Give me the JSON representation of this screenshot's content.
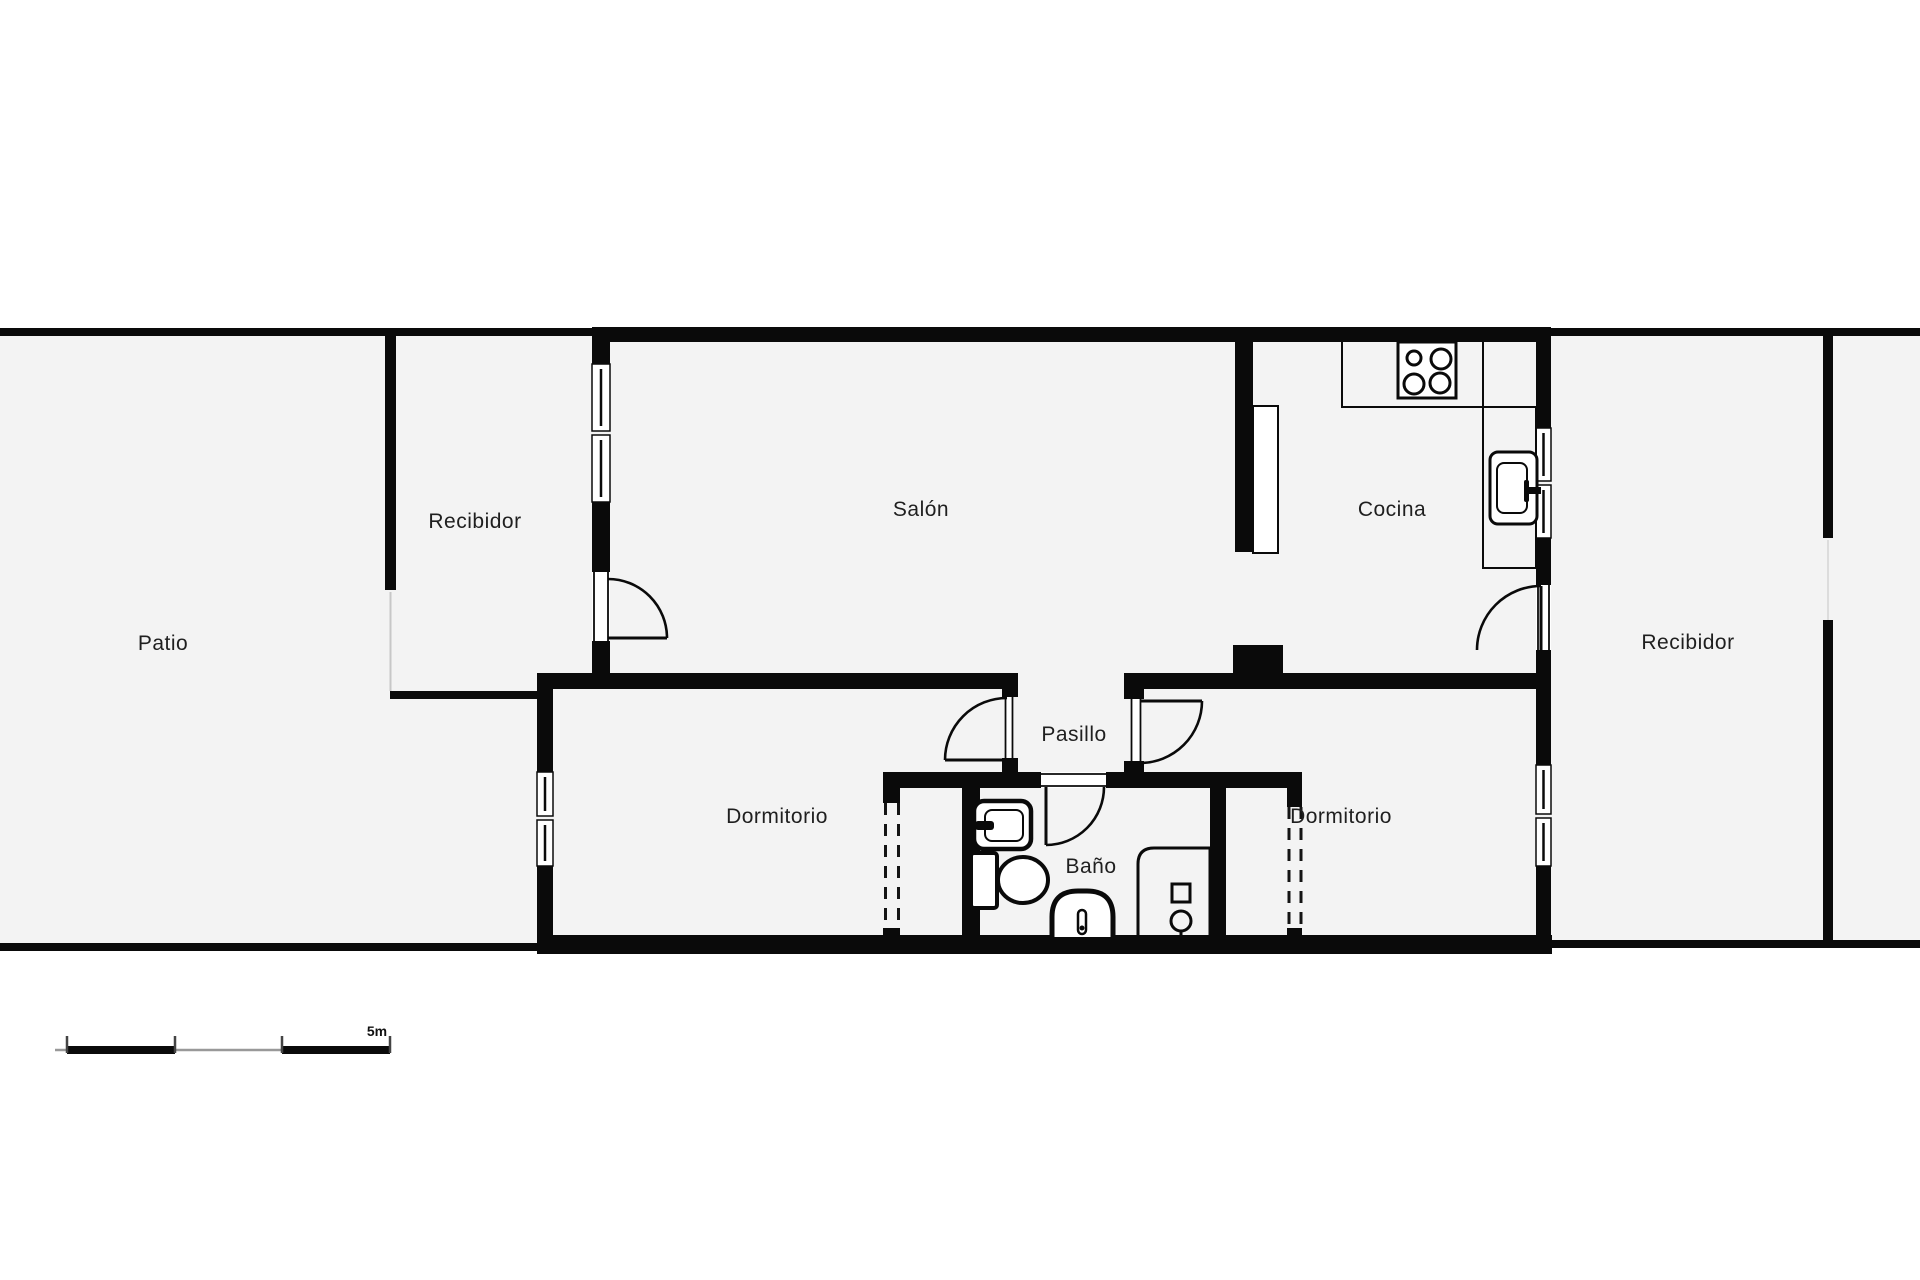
{
  "plan": {
    "type": "apartment-floor-plan",
    "rooms": [
      {
        "label": "Patio"
      },
      {
        "label": "Recibidor"
      },
      {
        "label": "Salón"
      },
      {
        "label": "Cocina"
      },
      {
        "label": "Recibidor"
      },
      {
        "label": "Dormitorio"
      },
      {
        "label": "Pasillo"
      },
      {
        "label": "Baño"
      },
      {
        "label": "Dormitorio"
      }
    ],
    "fixtures": [
      "stove-icon",
      "kitchen-sink-icon",
      "kitchen-counter",
      "bathroom-sink-icon",
      "toilet-icon",
      "bidet-icon",
      "shower-icon",
      "wardrobe-dashed-lines",
      "door-swing-arcs",
      "window-glazing"
    ],
    "scale_bar": {
      "label": "5m"
    },
    "colors": {
      "wall": "#0a0a0a",
      "floor": "#f3f3f3",
      "background": "#ffffff",
      "label": "#1f1f1f",
      "scale_thin_line": "#999999"
    }
  }
}
